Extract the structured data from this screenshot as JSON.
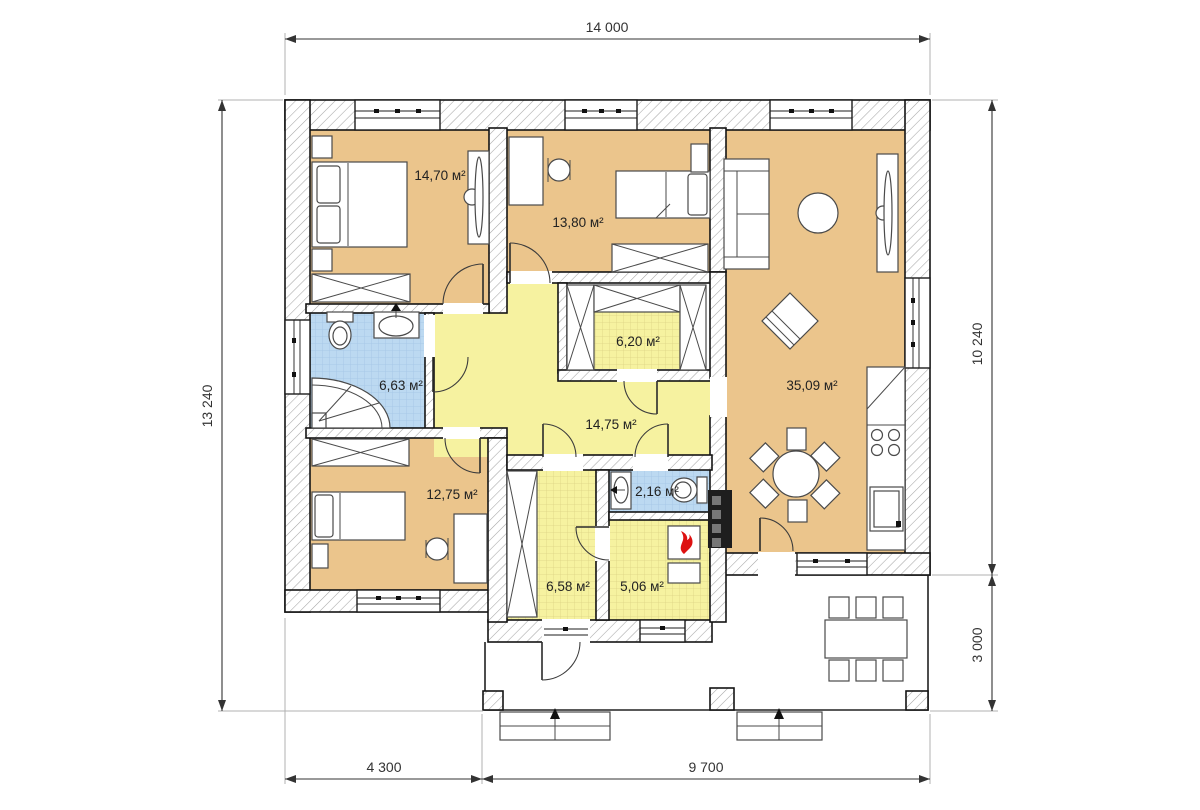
{
  "plan": {
    "title": "Single-storey house floor plan",
    "area_unit": "м²"
  },
  "dimensions": {
    "top": "14 000",
    "left": "13 240",
    "right_upper": "10 240",
    "right_lower": "3 000",
    "bottom_left": "4 300",
    "bottom_right": "9 700"
  },
  "rooms": [
    {
      "id": "bedroom-top-left",
      "area": "14,70 м²"
    },
    {
      "id": "bedroom-top-middle",
      "area": "13,80 м²"
    },
    {
      "id": "living-kitchen",
      "area": "35,09 м²"
    },
    {
      "id": "walk-in-closet",
      "area": "6,20 м²"
    },
    {
      "id": "bathroom",
      "area": "6,63 м²"
    },
    {
      "id": "hallway",
      "area": "14,75 м²"
    },
    {
      "id": "bedroom-bottom-left",
      "area": "12,75 м²"
    },
    {
      "id": "wc",
      "area": "2,16 м²"
    },
    {
      "id": "entry-hall",
      "area": "6,58 м²"
    },
    {
      "id": "boiler-room",
      "area": "5,06 м²"
    }
  ],
  "colors": {
    "wall-hatch": "#a6a6a6",
    "wall-stroke": "#141414",
    "room-tan": "#ebc58c",
    "room-yellow": "#f6f2a0",
    "grid-yellow-line": "#ddd385",
    "room-blue": "#bcd9f1",
    "grid-blue-line": "#a2c4e6",
    "furniture-stroke": "#4a4a4a",
    "dim-color": "#333333",
    "ext-line": "#b0b0b0",
    "flame-red": "#dd1111",
    "chimney-dark": "#1e1e1e"
  }
}
